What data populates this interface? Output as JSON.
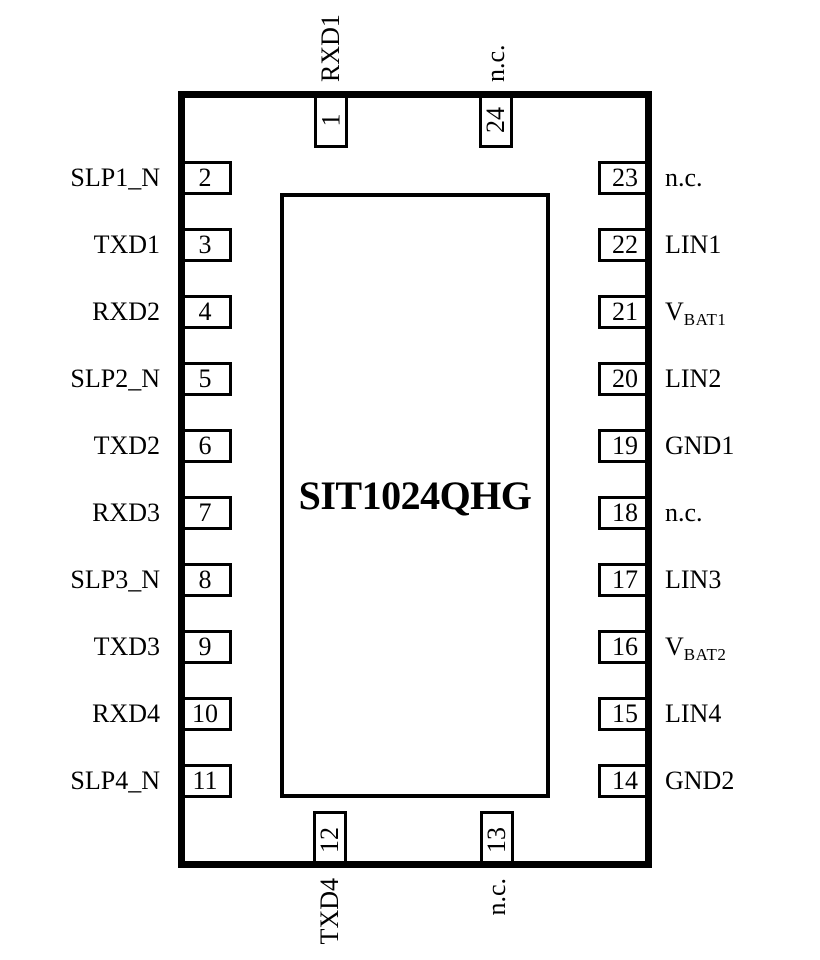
{
  "title": "SIT1024QHG",
  "colors": {
    "line": "#000000",
    "background": "#ffffff",
    "text": "#000000"
  },
  "pins": {
    "top": [
      {
        "number": "1",
        "label": "RXD1"
      },
      {
        "number": "24",
        "label": "n.c."
      }
    ],
    "bottom": [
      {
        "number": "12",
        "label": "TXD4"
      },
      {
        "number": "13",
        "label": "n.c."
      }
    ],
    "left": [
      {
        "number": "2",
        "label": "SLP1_N"
      },
      {
        "number": "3",
        "label": "TXD1"
      },
      {
        "number": "4",
        "label": "RXD2"
      },
      {
        "number": "5",
        "label": "SLP2_N"
      },
      {
        "number": "6",
        "label": "TXD2"
      },
      {
        "number": "7",
        "label": "RXD3"
      },
      {
        "number": "8",
        "label": "SLP3_N"
      },
      {
        "number": "9",
        "label": "TXD3"
      },
      {
        "number": "10",
        "label": "RXD4"
      },
      {
        "number": "11",
        "label": "SLP4_N"
      }
    ],
    "right": [
      {
        "number": "23",
        "label": "n.c."
      },
      {
        "number": "22",
        "label": "LIN1"
      },
      {
        "number": "21",
        "label": "V",
        "sub": "BAT1"
      },
      {
        "number": "20",
        "label": "LIN2"
      },
      {
        "number": "19",
        "label": "GND1"
      },
      {
        "number": "18",
        "label": "n.c."
      },
      {
        "number": "17",
        "label": "LIN3"
      },
      {
        "number": "16",
        "label": "V",
        "sub": "BAT2"
      },
      {
        "number": "15",
        "label": "LIN4"
      },
      {
        "number": "14",
        "label": "GND2"
      }
    ]
  }
}
